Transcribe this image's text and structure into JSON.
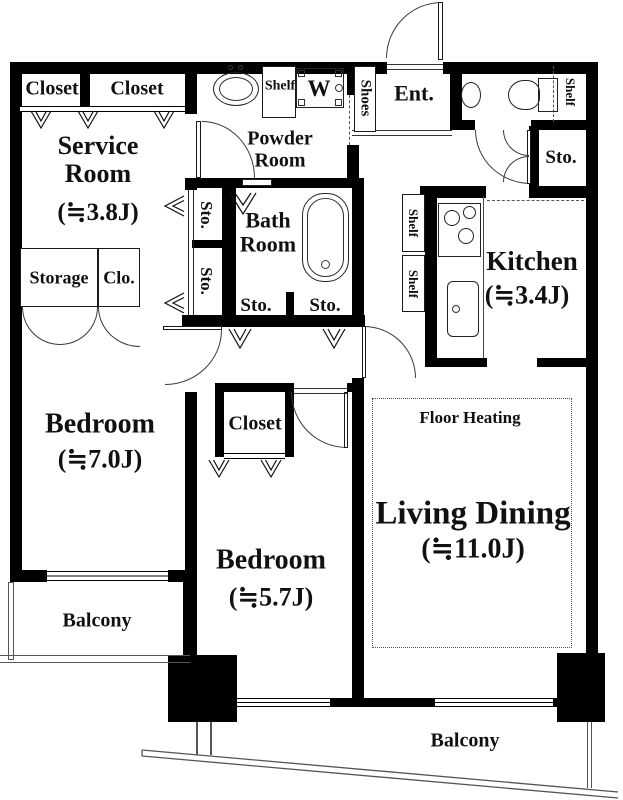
{
  "title": "Apartment floor plan",
  "colors": {
    "wall": "#000000",
    "background": "#ffffff",
    "text": "#111111",
    "line": "#3a3a3a"
  },
  "rooms": {
    "closet_a": {
      "label": "Closet"
    },
    "closet_b": {
      "label": "Closet"
    },
    "service_room": {
      "label": "Service Room",
      "size": "(≒3.8J)"
    },
    "storage": {
      "label": "Storage"
    },
    "clo": {
      "label": "Clo."
    },
    "bedroom_west": {
      "label": "Bedroom",
      "size": "(≒7.0J)"
    },
    "balcony_west": {
      "label": "Balcony"
    },
    "powder_room": {
      "label": "Powder Room"
    },
    "bath_room": {
      "label": "Bath Room"
    },
    "shoes": {
      "label": "Shoes"
    },
    "entrance": {
      "label": "Ent."
    },
    "kitchen": {
      "label": "Kitchen",
      "size": "(≒3.4J)"
    },
    "closet_center": {
      "label": "Closet"
    },
    "bedroom_center": {
      "label": "Bedroom",
      "size": "(≒5.7J)"
    },
    "living_dining": {
      "label": "Living Dining",
      "size": "(≒11.0J)"
    },
    "floor_heating": {
      "label": "Floor Heating"
    },
    "balcony_south": {
      "label": "Balcony"
    }
  },
  "storage_labels": {
    "sto_passage_upper": "Sto.",
    "sto_passage_lower": "Sto.",
    "sto_hall_left": "Sto.",
    "sto_hall_right": "Sto.",
    "sto_entry": "Sto."
  },
  "shelf_labels": {
    "powder": "Shelf",
    "toilet": "Shelf",
    "kitchen_a": "Shelf",
    "kitchen_b": "Shelf"
  },
  "fixtures": {
    "washer": "W"
  }
}
